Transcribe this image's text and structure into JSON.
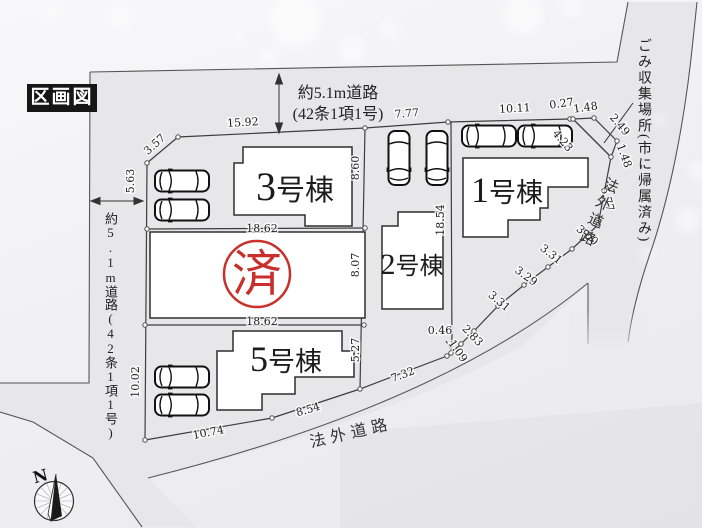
{
  "title": "区画図",
  "stamp": "済",
  "compass": {
    "north": "N"
  },
  "roads": {
    "top_line1": "約5.1m道路",
    "top_line2": "(42条1項1号)",
    "left": "約5.1m道路(42条1項1号)",
    "bottom": "法外道路",
    "right": "法外道路",
    "garbage": "ごみ収集場所(市に帰属済み)"
  },
  "buildings": [
    {
      "num": "1",
      "suffix": "号棟"
    },
    {
      "num": "2",
      "suffix": "号棟"
    },
    {
      "num": "3",
      "suffix": "号棟"
    },
    {
      "num": "5",
      "suffix": "号棟"
    }
  ],
  "dimensions": [
    "3.57",
    "5.63",
    "15.92",
    "7.77",
    "10.11",
    "0.27",
    "1.48",
    "2.49",
    "4.23",
    "1.48",
    "5.77",
    "3.00",
    "3.31",
    "3.29",
    "3.31",
    "2.83",
    "1.09",
    "0.46",
    "8.60",
    "18.54",
    "18.62",
    "8.07",
    "18.62",
    "5.27",
    "10.02",
    "10.74",
    "8.54",
    "7.32"
  ],
  "colors": {
    "plot_green": "#dcebd1",
    "road_gray": "#e7e7e9",
    "garbage_gray": "#b9b9be",
    "stamp_red": "#c9302c"
  }
}
